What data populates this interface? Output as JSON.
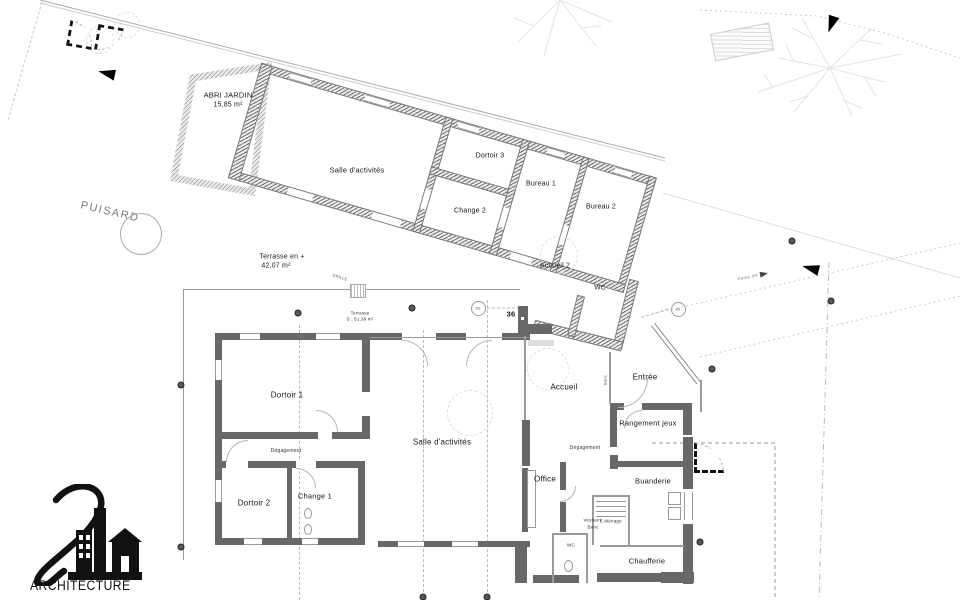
{
  "site": {
    "puisard": "PUISARD",
    "pente": "Pente 4%",
    "grille": "GRILLE"
  },
  "upper_building": {
    "abri_name": "ABRI JARDIN",
    "abri_area": "15,85 m²",
    "salle": "Salle d'activités",
    "dortoir3": "Dortoir 3",
    "change2": "Change 2",
    "bureau1": "Bureau 1",
    "bureau2": "Bureau 2",
    "accueil2": "Accueil 2",
    "wc": "WC"
  },
  "terrace": {
    "upper_name": "Terrasse en +",
    "upper_area": "42,07 m²",
    "lower_name": "Terrasse",
    "lower_area": "S : 51,38 m²",
    "jd": "JD",
    "marker": "36"
  },
  "main_building": {
    "dortoir1": "Dortoir 1",
    "degagement1": "Dégagement",
    "dortoir2": "Dortoir 2",
    "change1": "Change 1",
    "salle": "Salle d'activités",
    "accueil": "Accueil",
    "entree": "Entrée",
    "rangement": "Rangement jeux",
    "degagement2": "Dégagement",
    "office": "Office",
    "buanderie": "Buanderie",
    "vestiaire_line1": "Vestiaire",
    "vestiaire_line2": "Banc",
    "lmenage": "L.Ménage",
    "wc": "WC",
    "chaufferie": "Chaufferie",
    "banc": "Banc"
  },
  "logo": {
    "word": "ARCHITECTURE"
  },
  "colors": {
    "wall_solid": "#686868",
    "wall_hatch": "#6f6f6f",
    "thin_line": "#9a9a9a",
    "marker_black": "#000000"
  }
}
